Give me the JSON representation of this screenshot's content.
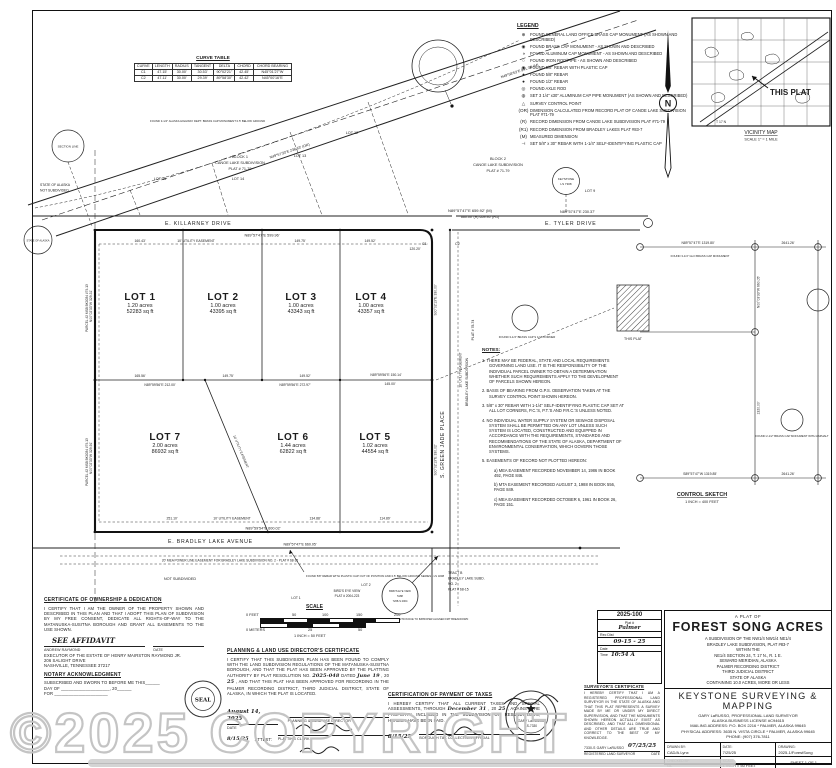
{
  "watermark": "©2025 COPYRIGHT",
  "curve_table": {
    "title": "CURVE TABLE",
    "headers": [
      "CURVE",
      "LENGTH",
      "RADIUS",
      "TANGENT",
      "DELTA",
      "CHORD",
      "CHORD BEARING"
    ],
    "rows": [
      [
        "C1",
        "47.15'",
        "30.00'",
        "30.53'",
        "90°02'21\"",
        "42.45'",
        "N45°01'27\"W"
      ],
      [
        "C2",
        "47.11'",
        "30.00'",
        "29.39'",
        "89°58'30\"",
        "42.42'",
        "N45°00'16\"E"
      ]
    ]
  },
  "legend": {
    "title": "LEGEND",
    "items": [
      {
        "sym": "⊕",
        "text": "FOUND GENERAL LAND OFFICE BRASS CAP MONUMENT (AS SHOWN AND DESCRIBED)"
      },
      {
        "sym": "◉",
        "text": "FOUND BRASS CAP MONUMENT - AS SHOWN AND DESCRIBED"
      },
      {
        "sym": "◑",
        "text": "FOUND ALUMINUM CAP MONUMENT - AS SHOWN AND DESCRIBED"
      },
      {
        "sym": "○",
        "text": "FOUND IRON ROD/PIPE - AS SHOWN AND DESCRIBED"
      },
      {
        "sym": "◉",
        "text": "FOUND 5/8\" REBAR WITH PLASTIC CAP"
      },
      {
        "sym": "●",
        "text": "FOUND 5/8\" REBAR"
      },
      {
        "sym": "●",
        "text": "FOUND 1/2\" REBAR"
      },
      {
        "sym": "◎",
        "text": "FOUND AXLE ROD"
      },
      {
        "sym": "◍",
        "text": "SET 3 1/4\" x30\" ALUMINUM CAP PIPE MONUMENT (AS SHOWN AND DESCRIBED)"
      },
      {
        "sym": "△",
        "text": "SURVEY CONTROL POINT"
      },
      {
        "sym": "(OR)",
        "text": "DIMENSION CALCULATED FROM RECORD PLAT OF CANOE LAKE SUBDIVISION PLAT #71-79"
      },
      {
        "sym": "(R)",
        "text": "RECORD DIMENSION FROM CANOE LAKE SUBDIVISION PLAT #71-79"
      },
      {
        "sym": "(R1)",
        "text": "RECORD DIMENSION FROM BRADLEY LAKES PLAT #83-7"
      },
      {
        "sym": "(M)",
        "text": "MEASURED DIMENSION"
      },
      {
        "sym": "⊣",
        "text": "SET 5/8\" x 30\" REBAR WITH 1-1/4\" SELF-IDENTIFYING PLASTIC CAP"
      }
    ],
    "cap1": "KEYSTONE",
    "cap2": "LS 7308"
  },
  "north": {
    "letter": "N"
  },
  "vicinity": {
    "callout": "THIS PLAT",
    "title": "VICINITY MAP",
    "scale": "SCALE 1\" = 1 MILE",
    "township": "T 17 N"
  },
  "plat": {
    "streets": {
      "killarney": "E. KILLARNEY DRIVE",
      "tyler": "E. TYLER DRIVE",
      "green_jade": "S. GREEN JADE PLACE",
      "bradley": "E. BRADLEY LAKE AVENUE"
    },
    "lots": [
      {
        "name": "LOT 1",
        "acres": "1.20 acres",
        "sqft": "52283 sq ft"
      },
      {
        "name": "LOT 2",
        "acres": "1.00 acres",
        "sqft": "43395 sq ft"
      },
      {
        "name": "LOT 3",
        "acres": "1.00 acres",
        "sqft": "43343 sq ft"
      },
      {
        "name": "LOT 4",
        "acres": "1.00 acres",
        "sqft": "43357 sq ft"
      },
      {
        "name": "LOT 5",
        "acres": "1.02 acres",
        "sqft": "44554 sq ft"
      },
      {
        "name": "LOT 6",
        "acres": "1.44 acres",
        "sqft": "62822 sq ft"
      },
      {
        "name": "LOT 7",
        "acres": "2.00 acres",
        "sqft": "86932 sq ft"
      }
    ],
    "labels": {
      "block1a": "BLOCK 1",
      "block1b": "CANOE LAKE SUBDIVISION",
      "block1c": "PLAT # 71-79",
      "block2a": "BLOCK 2",
      "block2b": "CANOE LAKE SUBDIVISION",
      "block2c": "PLAT # 71-79",
      "lot12": "LOT 12",
      "lot13": "LOT 13",
      "lot14": "LOT 14",
      "lot15": "LOT 15",
      "lot9": "LOT 9",
      "state1": "STATE OF ALASKA",
      "state2": "NOT SUBDIVIDED",
      "parcel1": "PARCEL #2 MSB BK0034 #79-13",
      "parcel2": "PARCEL #2 MSB BK0034 #79-13",
      "section_line": "SECTION LINE",
      "bradley_sub": "BRADLEY LAKE SUBDIVISION",
      "bradley_plat": "PLAT # 78-74",
      "not_subdivided": "NOT SUBDIVIDED",
      "tract_b1": "TRACT B",
      "tract_b2": "BRADLEY LAKE SUBD.",
      "tract_b3": "NO. 2",
      "tract_b4": "PLAT # 68-15",
      "birdseye1": "BIRD'S EYE VIEW",
      "birdseye2": "PLAT # 2004-223",
      "be_lot1": "LOT 1",
      "be_lot2": "LOT 2",
      "be_c1": "BIRD'S EYE VIEW",
      "be_c2": "5188",
      "be_c3": "7268-S  2004",
      "power_easement": "20' MEA POWER LINE EASEMENT FOR BRADLEY LAKE SUBDIVISION NO. 2  -  PLAT # 68-15",
      "util_easement": "10' UTILITY EASEMENT",
      "c1": "C1",
      "c2": "C2",
      "found_rebar_note": "FOUND 5/8\" REBAR WITH PLASTIC CAP OUT OF POSITION AND 0.5' BELOW GROUND  SERIES - LS 3208",
      "found_bc_note": "FOUND 3-1/4\" BRASS CAP MONUMENT OUT OF POSITION DUE TO IMPROPER ALIGNED FMT BREAKDOWN",
      "hwy_note": "FOUND 3-1/4\" ALASKA HIGHWAY DEPT. BRASS CAP MONUMENT 0.5' BELOW GROUND"
    },
    "dims": {
      "top": "N89°57'47\"E  659.92' (M)",
      "top_r": "660.00' (R)   659.95' (R1)",
      "killarney": "N89°57'47\"E  599.96'",
      "tyler": "N89°57'47\"E  230.37'",
      "w1": "160.43'",
      "w2": "149.75'",
      "w3": "149.52'",
      "w4": "120.20'",
      "m1": "165.56'",
      "m2": "149.75'",
      "m3": "149.52'",
      "m4": "N89°59'56\"E  150.14'",
      "m5": "145.00'",
      "m6": "N89°59'56\"E  212.00'",
      "m7": "N89°59'56\"E  272.97'",
      "b1": "251.10'",
      "b2": "134.88'",
      "b3": "114.89'",
      "bottom": "N89°59'54\"E  600.02'",
      "ave": "N89°57'47\"E  660.05'",
      "left1": "N00°02'33\"W  329.31'",
      "left2": "N00°02'33\"W  329.91'",
      "right1": "S00°02'13\"E  330.00'",
      "right2": "S00°02'13\"E  330.02'",
      "road1": "N49°57'33\"E  238.63' (OR)",
      "road2": "N49°58'53\"E  941.38' (M)"
    }
  },
  "notes": {
    "title": "NOTES:",
    "n1": "1.  THERE MAY BE FEDERAL, STATE AND LOCAL REQUIREMENTS GOVERNING LAND USE. IT IS THE RESPONSIBILITY OF THE INDIVIDUAL PARCEL OWNER TO OBTAIN A DETERMINATION WHETHER SUCH REQUIREMENTS APPLY TO THE DEVELOPMENT OF PARCELS SHOWN HEREON.",
    "n2": "2.  BASIS OF BEARING FROM G.P.S. OBSERVATION TAKEN AT THE SURVEY CONTROL POINT SHOWN HEREON.",
    "n3": "3.  5/8\" x 30\" REBAR WITH 1-1/4\" SELF-IDENTIFYING PLASTIC CAP SET AT ALL LOT CORNERS, P.C.'S, P.T.'S AND P.R.C.'S UNLESS NOTED.",
    "n4": "4.  NO INDIVIDUAL WATER SUPPLY SYSTEM OR SEWAGE DISPOSAL SYSTEM SHALL BE PERMITTED ON ANY LOT UNLESS SUCH SYSTEM IS LOCATED, CONSTRUCTED AND EQUIPPED IN ACCORDANCE WITH THE REQUIREMENTS, STANDARDS AND RECOMMENDATIONS OF THE STATE OF ALASKA, DEPARTMENT OF ENVIRONMENTAL CONSERVATION, WHICH GOVERN THOSE SYSTEMS.",
    "n5": "5.  EASEMENTS OF RECORD NOT PLOTTED HEREON:",
    "n5a": "a) MEA EASEMENT RECORDED NOVEMBER 14, 1986 IN BOOK 492, PAGE 846.",
    "n5b": "b) MTA EASEMENT RECORDED AUGUST 3, 1988 IN BOOK 556, PAGE 849.",
    "n5c": "c) MEA EASEMENT RECORDED OCTOBER 6, 1961 IN BOOK 26, PAGE 151."
  },
  "control": {
    "title": "CONTROL SKETCH",
    "scale": "1 INCH = 400 FEET",
    "this_plat": "THIS PLAT",
    "d1": "N89°57'47\"E  1319.80'",
    "d2": "2641.26'",
    "d3": "N00°03'33\"W  660.05'",
    "d4": "S89°57'47\"W  1319.85'",
    "d5": "1320.00'",
    "d6": "2641.26'",
    "m1": "FOUND 3-1/4\" GLO BRASS CAP MONUMENT",
    "m2": "FOUND 2-1/2\" BRASS CAP MONUMENT WITH ASPHALT",
    "m3": "FOUND 3-1/4\" BRASS CAP S 1/16 CORNER"
  },
  "scale_bar": {
    "title": "SCALE",
    "f0": "0 FEET",
    "f50": "50",
    "f100": "100",
    "f150": "150",
    "f200": "200",
    "m0": "0 METERS",
    "m25": "25",
    "m50": "50",
    "caption": "1 INCH = 50 FEET"
  },
  "certs": {
    "ownership": {
      "title": "CERTIFICATE OF OWNERSHIP & DEDICATION",
      "body": "I CERTIFY THAT I AM THE OWNER OF THE PROPERTY SHOWN AND DESCRIBED IN THIS PLAN AND THAT I ADOPT THIS PLAN OF SUBDIVISION BY MY FREE CONSENT, DEDICATE ALL RIGHTS-OF-WAY TO THE MATANUSKA-SUSITNA BOROUGH AND GRANT ALL EASEMENTS TO THE USE SHOWN.",
      "affidavit": "SEE AFFIDAVIT",
      "date_label": "DATE",
      "owner": "ANDREW RAYMOND",
      "owner2": "EXECUTOR OF THE ESTATE OF HENRY MAIRSTON RAYMOND JR.",
      "owner3": "206 SALIGHT DRIVE",
      "owner4": "NASHVILLE, TENNESSEE  37217"
    },
    "notary": {
      "title": "NOTARY ACKNOWLEDGMENT",
      "l1": "SUBSCRIBED AND SWORN TO BEFORE ME THIS______",
      "l2": "DAY OF ____________________, 20______",
      "l3": "FOR ______________________",
      "seal": "SEAL"
    },
    "planning": {
      "title": "PLANNING & LAND USE DIRECTOR'S CERTIFICATE",
      "b1": "I CERTIFY THAT THIS SUBDIVISION PLAN HAS BEEN FOUND TO COMPLY WITH THE LAND SUBDIVISION REGULATIONS OF THE MATANUSKA-SUSITNA BOROUGH, AND THAT THE PLAT HAS BEEN APPROVED BY THE PLATTING AUTHORITY BY PLAT RESOLUTION NO. ",
      "hw1": "2025-048",
      "b2": " DATED ",
      "hw2": "June 19",
      "b3": ", 20",
      "hw3": "25",
      "b4": ", AND THAT THIS PLAT HAS BEEN APPROVED FOR RECORDING IN THE PALMER RECORDING DISTRICT, THIRD JUDICIAL DISTRICT, STATE OF ALASKA, IN WHICH THE PLAT IS LOCATED.",
      "hw_date": "August 14, 2025",
      "date_label": "DATE",
      "dir_label": "PLANNING & LAND USE DIRECTOR",
      "attest": "ATTEST:",
      "hw_attest_date": "8/15/25",
      "clerk": "PLATTING CLERK"
    },
    "taxes": {
      "title": "CERTIFICATION OF PAYMENT OF TAXES",
      "b1": "I HEREBY CERTIFY THAT ALL CURRENT TAXES AND SPECIAL ASSESSMENTS, THROUGH ",
      "hw1": "December 31",
      "b2": ", 20",
      "hw2": "25",
      "b3": ", AGAINST THE PROPERTY, INCLUDED IN THE SUBDIVISION OR RESUBDIVISION, HEREON HAVE BEEN PAID.",
      "hw_date": "8/15/25",
      "official": "BOROUGH TAX COLLECTION OFFICIAL"
    },
    "surveyor": {
      "title": "SURVEYOR'S CERTIFICATE",
      "body": "I HEREBY CERTIFY THAT I AM A REGISTERED PROFESSIONAL LAND SURVEYOR IN THE STATE OF ALASKA AND THAT THIS PLAT REPRESENTS A SURVEY MADE BY ME OR UNDER MY DIRECT SUPERVISION, AND THAT THE MONUMENTS SHOWN HEREON ACTUALLY EXIST AS DESCRIBED, AND THAT ALL DIMENSIONAL AND OTHER DETAILS ARE TRUE AND CORRECT TO THE BEST OF MY KNOWLEDGE.",
      "reg": "7330-S   GARY LaRUSSO",
      "hw_date": "07/25/25",
      "l1": "REGISTERED LAND SURVEYOR",
      "l2": "DATE",
      "seal_name": "GARY LaRUSSO",
      "seal_no": "LS-7330"
    }
  },
  "recording": {
    "number": "2025-100",
    "plat_label": "Plat #",
    "plat_value": "Palmer",
    "rec_label": "Rec Dist",
    "rec_value": "09-15 - 25",
    "date_label": "Date",
    "time_label": "Time",
    "time_value": "10:54 A"
  },
  "title_block": {
    "plat_of": "A PLAT OF",
    "name": "FOREST SONG ACRES",
    "sub1": "A SUBDIVISION OF THE NW1/4 NW1/4 NE1/4",
    "sub2": "BRADLEY LAKE SUBDIVISION, PLAT #83-7",
    "sub3": "WITHIN THE",
    "sub4": "NE1/4 SECTION 24, T. 17 N., R. 1 E.",
    "sub5": "SEWARD MERIDIAN, ALASKA",
    "sub6": "PALMER RECORDING DISTRICT",
    "sub7": "THIRD JUDICIAL DISTRICT",
    "sub8": "STATE OF ALASKA",
    "sub9": "CONTAINING 10.0 ACRES, MORE OR LESS",
    "firm": "KEYSTONE SURVEYING & MAPPING",
    "firm2": "GARY LaRUSSO, PROFESSIONAL LAND SURVEYOR",
    "firm3": "ALASKA BUSINESS LICENSE #C94615",
    "firm4": "MAILING ADDRESS: P.O. BOX 2216 * PALMER, ALASKA 99645",
    "firm5": "PHYSICAL ADDRESS: 3635 N. VISTA CIRCLE * PALMER, ALASKA 99645",
    "firm6": "PHONE: (907) 376-7811",
    "drawn_label": "DRAWN BY:",
    "drawn": "CAD/A.Lynx",
    "date_label": "DATE:",
    "date": "7/25/25",
    "drawing_label": "DRAWING:",
    "drawing": "2025-1/ForestSong",
    "checked_label": "CHECKED BY:",
    "checked": "GL",
    "scale_label": "SCALE:",
    "scale": "1 INCH = 50 FEET",
    "sheet": "SHEET 1 OF 1"
  }
}
